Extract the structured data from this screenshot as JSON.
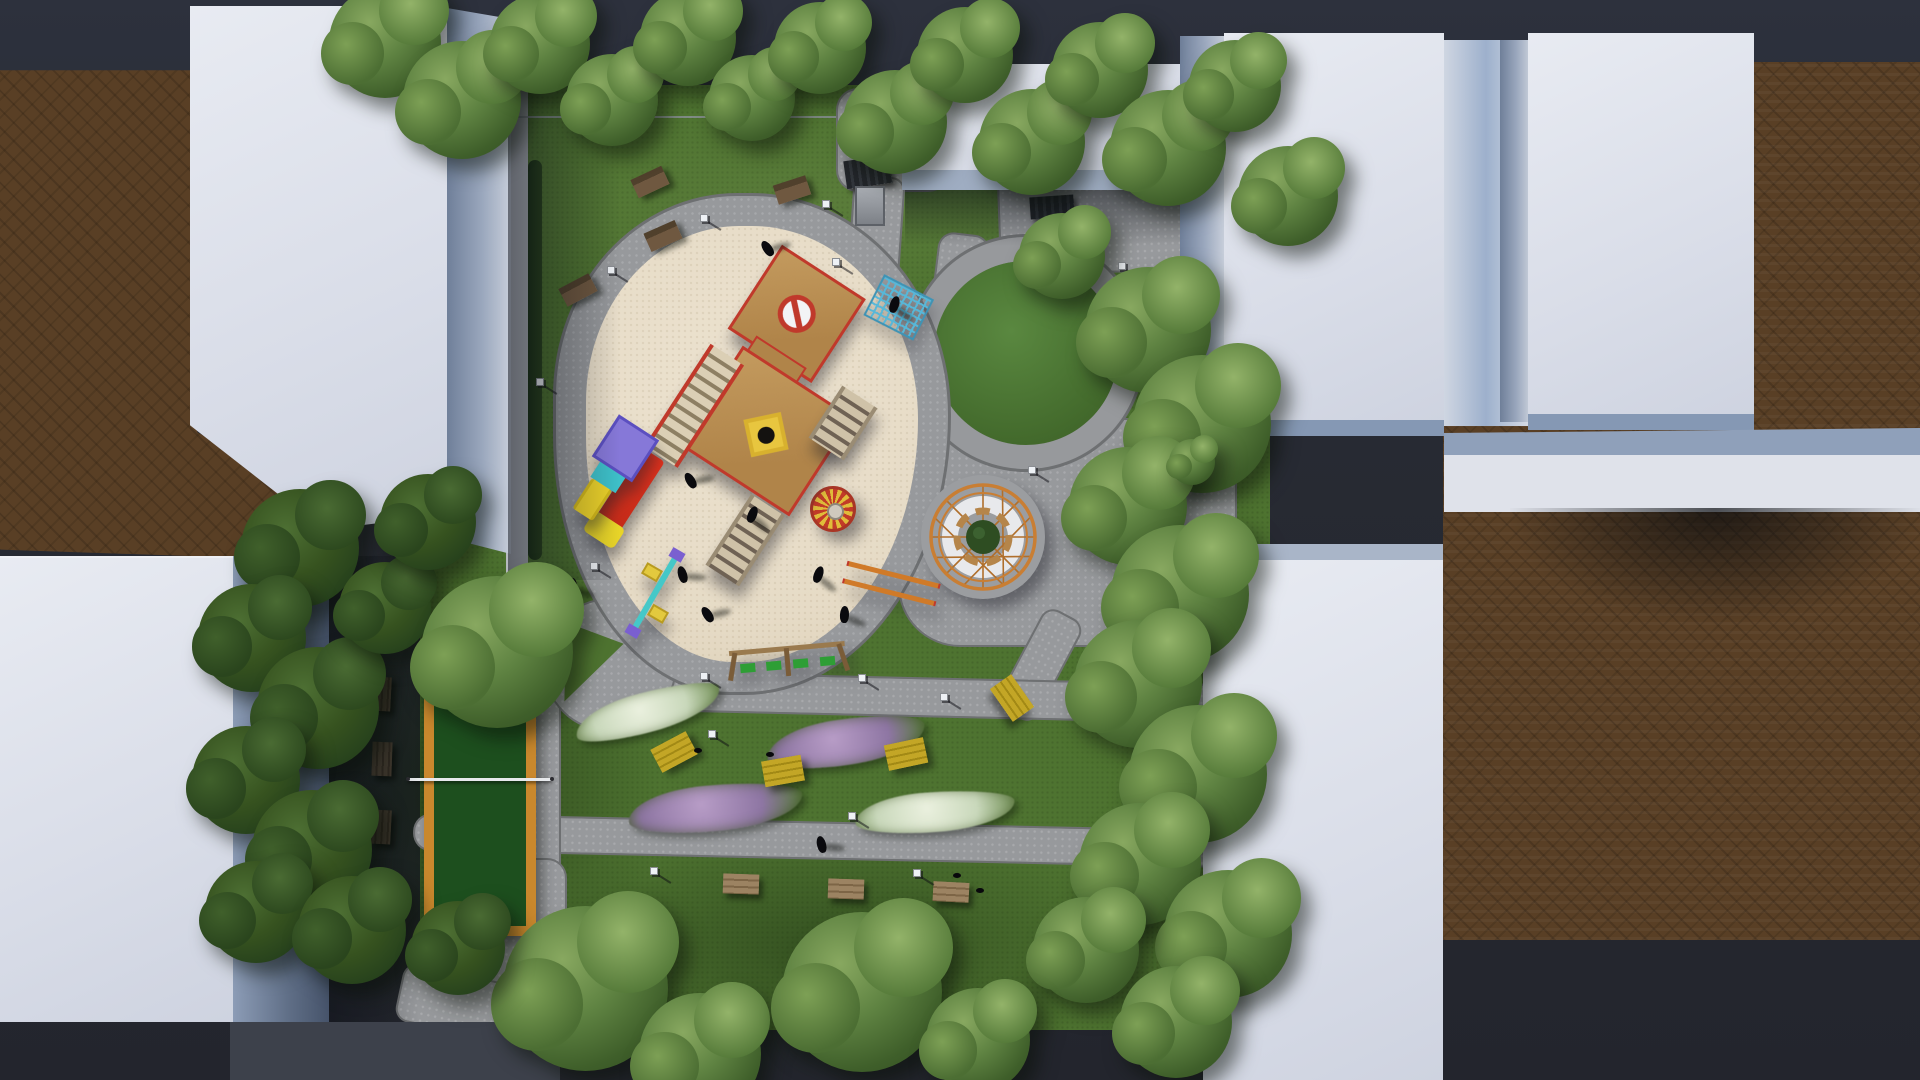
{
  "meta": {
    "title": "Aerial 3D architectural render of a courtyard playground park between residential buildings",
    "view": "top-down bird's-eye",
    "visible_text": "none"
  },
  "palette": {
    "asphalt": "#282b34",
    "asphalt_top": "#2d313d",
    "asphalt_bottom": "#23252d",
    "brick": "#593f25",
    "grass": "#4e7330",
    "grass_dark": "#2c4a1e",
    "path": "#97999c",
    "path_edge": "#6e7072",
    "sand": "#e6dbc6",
    "court_green": "#1d4f1e",
    "court_border": "#c9882d",
    "carousel_red": "#c23b28",
    "accent_yellow": "#e0bc3a",
    "pergola_orange": "#c97e33",
    "roof_white": "#dde0e9",
    "wall_shade": "#8fa0ba",
    "bench_yellow": "#b5991f",
    "bench_wood": "#8a6f4b",
    "bench_dark": "#3e362e",
    "flower_purple": "#9b82ad",
    "flower_white": "#dfe6d4",
    "swing_green": "#2e9e35",
    "slide_red": "#d63320",
    "kid_purple": "#8678d8",
    "kid_teal": "#3ec0c9",
    "tree_light": "#5f8342",
    "tree_dark": "#36521f"
  },
  "counts": {
    "white_buildings": 7,
    "swing_seats": 4,
    "carousel": 1,
    "circular_pergola": 1,
    "slides": 2,
    "sports_court": 1,
    "benches_total": 14,
    "street_lamps": 15,
    "people": 10,
    "birds": 4,
    "flower_beds": 4,
    "trees": 41
  },
  "features": {
    "playground_surface": "beige rubber safety surface oval ringed by paved path",
    "main_play_structure": "tan multi-tower unit with red trim, stairs, blue climbing net, red slide with yellow end, no-entry roof sign, yellow activity panel",
    "toddler_unit": "purple/teal unit with yellow slide",
    "spinner": "red and yellow striped carousel",
    "pergola": "circular wooden pergola with perimeter benches around a central tree",
    "seesaw": "teal/purple seesaw with yellow seats",
    "swing_set": "wooden frame with four green seats",
    "balance_bars": "orange parallel rails",
    "court": "dark green mini court with orange border and center net",
    "shelters": "two dark utility shelters near north entrance"
  },
  "scene": {
    "trees": [
      {
        "x": 385,
        "y": 42,
        "d": 112,
        "tone": "light"
      },
      {
        "x": 462,
        "y": 100,
        "d": 118,
        "tone": "light"
      },
      {
        "x": 540,
        "y": 44,
        "d": 100,
        "tone": "light"
      },
      {
        "x": 612,
        "y": 100,
        "d": 92,
        "tone": "light"
      },
      {
        "x": 688,
        "y": 38,
        "d": 96,
        "tone": "light"
      },
      {
        "x": 752,
        "y": 98,
        "d": 86,
        "tone": "light"
      },
      {
        "x": 820,
        "y": 48,
        "d": 92,
        "tone": "light"
      },
      {
        "x": 895,
        "y": 122,
        "d": 104,
        "tone": "light"
      },
      {
        "x": 965,
        "y": 55,
        "d": 96,
        "tone": "light"
      },
      {
        "x": 1032,
        "y": 142,
        "d": 106,
        "tone": "light"
      },
      {
        "x": 1100,
        "y": 70,
        "d": 96,
        "tone": "light"
      },
      {
        "x": 1168,
        "y": 148,
        "d": 116,
        "tone": "light"
      },
      {
        "x": 1235,
        "y": 86,
        "d": 92,
        "tone": "light"
      },
      {
        "x": 1288,
        "y": 196,
        "d": 100,
        "tone": "light"
      },
      {
        "x": 1062,
        "y": 256,
        "d": 86,
        "tone": "light"
      },
      {
        "x": 1148,
        "y": 330,
        "d": 126,
        "tone": "light"
      },
      {
        "x": 1202,
        "y": 424,
        "d": 138,
        "tone": "light"
      },
      {
        "x": 1128,
        "y": 506,
        "d": 118,
        "tone": "light"
      },
      {
        "x": 1180,
        "y": 594,
        "d": 138,
        "tone": "light"
      },
      {
        "x": 1138,
        "y": 684,
        "d": 128,
        "tone": "light"
      },
      {
        "x": 1198,
        "y": 774,
        "d": 138,
        "tone": "light"
      },
      {
        "x": 1140,
        "y": 864,
        "d": 122,
        "tone": "light"
      },
      {
        "x": 1228,
        "y": 934,
        "d": 128,
        "tone": "light"
      },
      {
        "x": 1086,
        "y": 950,
        "d": 106,
        "tone": "light"
      },
      {
        "x": 1176,
        "y": 1022,
        "d": 112,
        "tone": "light"
      },
      {
        "x": 585,
        "y": 988,
        "d": 165,
        "tone": "light"
      },
      {
        "x": 700,
        "y": 1054,
        "d": 122,
        "tone": "light"
      },
      {
        "x": 862,
        "y": 992,
        "d": 160,
        "tone": "light"
      },
      {
        "x": 978,
        "y": 1040,
        "d": 104,
        "tone": "light"
      },
      {
        "x": 300,
        "y": 548,
        "d": 118,
        "tone": "dark"
      },
      {
        "x": 252,
        "y": 638,
        "d": 108,
        "tone": "dark"
      },
      {
        "x": 318,
        "y": 708,
        "d": 122,
        "tone": "dark"
      },
      {
        "x": 246,
        "y": 780,
        "d": 108,
        "tone": "dark"
      },
      {
        "x": 312,
        "y": 850,
        "d": 120,
        "tone": "dark"
      },
      {
        "x": 256,
        "y": 912,
        "d": 102,
        "tone": "dark"
      },
      {
        "x": 385,
        "y": 608,
        "d": 92,
        "tone": "dark"
      },
      {
        "x": 352,
        "y": 930,
        "d": 108,
        "tone": "dark"
      },
      {
        "x": 428,
        "y": 522,
        "d": 96,
        "tone": "dark"
      },
      {
        "x": 458,
        "y": 948,
        "d": 94,
        "tone": "dark"
      },
      {
        "x": 497,
        "y": 652,
        "d": 152,
        "tone": "light"
      },
      {
        "x": 1192,
        "y": 462,
        "d": 46,
        "tone": "light"
      }
    ],
    "lamps": [
      {
        "x": 607,
        "y": 266
      },
      {
        "x": 536,
        "y": 378
      },
      {
        "x": 590,
        "y": 562
      },
      {
        "x": 700,
        "y": 672
      },
      {
        "x": 858,
        "y": 674
      },
      {
        "x": 940,
        "y": 693
      },
      {
        "x": 708,
        "y": 730
      },
      {
        "x": 848,
        "y": 812
      },
      {
        "x": 913,
        "y": 869
      },
      {
        "x": 650,
        "y": 867
      },
      {
        "x": 700,
        "y": 214
      },
      {
        "x": 822,
        "y": 200
      },
      {
        "x": 832,
        "y": 258
      },
      {
        "x": 1028,
        "y": 466
      },
      {
        "x": 1118,
        "y": 262
      }
    ],
    "people": [
      {
        "x": 763,
        "y": 240
      },
      {
        "x": 890,
        "y": 296
      },
      {
        "x": 568,
        "y": 578
      },
      {
        "x": 678,
        "y": 566
      },
      {
        "x": 703,
        "y": 606
      },
      {
        "x": 814,
        "y": 566
      },
      {
        "x": 840,
        "y": 606
      },
      {
        "x": 817,
        "y": 836
      },
      {
        "x": 686,
        "y": 472
      },
      {
        "x": 748,
        "y": 506
      }
    ],
    "birds": [
      {
        "x": 953,
        "y": 873
      },
      {
        "x": 976,
        "y": 888
      },
      {
        "x": 766,
        "y": 752
      },
      {
        "x": 694,
        "y": 748
      }
    ],
    "benches": [
      {
        "type": "wood-top",
        "x": 650,
        "y": 182,
        "rot": -25
      },
      {
        "type": "wood-top",
        "x": 792,
        "y": 190,
        "rot": -18
      },
      {
        "type": "wood-top",
        "x": 578,
        "y": 290,
        "rot": -28
      },
      {
        "type": "wood-top",
        "x": 663,
        "y": 236,
        "rot": -24
      },
      {
        "type": "yellow",
        "x": 674,
        "y": 752,
        "rot": -28
      },
      {
        "type": "yellow",
        "x": 783,
        "y": 771,
        "rot": -10
      },
      {
        "type": "yellow",
        "x": 906,
        "y": 754,
        "rot": -12
      },
      {
        "type": "yellow",
        "x": 1012,
        "y": 698,
        "rot": 55
      },
      {
        "type": "wood-bottom",
        "x": 741,
        "y": 884,
        "rot": 2
      },
      {
        "type": "wood-bottom",
        "x": 846,
        "y": 889,
        "rot": 2
      },
      {
        "type": "wood-bottom",
        "x": 951,
        "y": 892,
        "rot": 3
      },
      {
        "type": "dark",
        "x": 381,
        "y": 694,
        "rot": 3
      },
      {
        "type": "dark",
        "x": 382,
        "y": 759,
        "rot": 2
      },
      {
        "type": "dark",
        "x": 381,
        "y": 827,
        "rot": 3
      }
    ],
    "flower_beds": [
      {
        "kind": "white",
        "x": 648,
        "y": 712,
        "w": 150,
        "h": 40,
        "rot": -15
      },
      {
        "kind": "purple",
        "x": 846,
        "y": 742,
        "w": 160,
        "h": 46,
        "rot": -8
      },
      {
        "kind": "purple",
        "x": 715,
        "y": 808,
        "w": 175,
        "h": 46,
        "rot": -5
      },
      {
        "kind": "white",
        "x": 935,
        "y": 812,
        "w": 160,
        "h": 40,
        "rot": -4
      }
    ]
  }
}
